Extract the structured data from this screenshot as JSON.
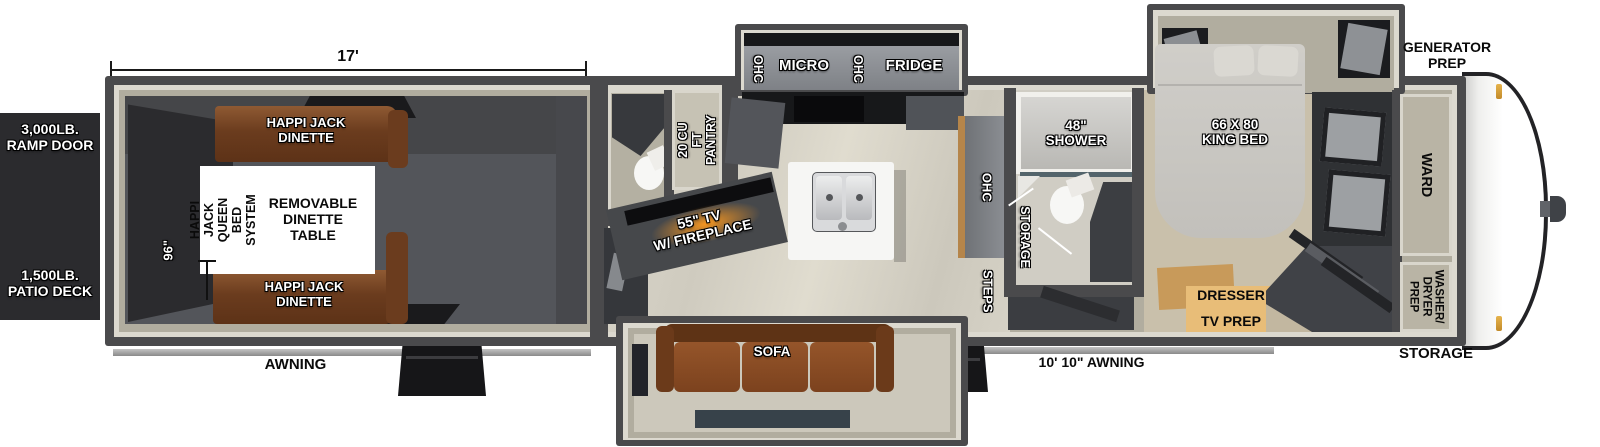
{
  "colors": {
    "wall": "#4a4a4c",
    "wall_lining": "#dcd9cf",
    "interior_tan": "#b1ad9f",
    "garage_floor": "#53555a",
    "side_panel": "#2b2b2e",
    "dinette_brown": "#7b4726",
    "sofa_brown": "#83491f",
    "fireplace_glow": "#ff9a1e",
    "dresser_tan": "#e8bd78"
  },
  "exterior": {
    "ramp_door": "3,000LB.\nRAMP DOOR",
    "patio_deck": "1,500LB.\nPATIO DECK",
    "garage_length": "17'",
    "garage_width": "96\"",
    "awning_rear": "AWNING",
    "awning_main": "10' 10\" AWNING",
    "generator_prep": "GENERATOR\nPREP",
    "storage": "STORAGE"
  },
  "garage": {
    "dinette_front": "HAPPI JACK\nDINETTE",
    "dinette_rear": "HAPPI JACK\nDINETTE",
    "queen_bed_system": "HAPPI JACK\nQUEEN BED\nSYSTEM",
    "removable_table": "REMOVABLE\nDINETTE\nTABLE"
  },
  "living": {
    "tv_fireplace": "55\" TV\nW/ FIREPLACE",
    "pantry": "20 CU FT\nPANTRY",
    "sofa": "SOFA",
    "steps": "STEPS",
    "counter_ohc": "OHC"
  },
  "kitchen": {
    "ohc_left": "OHC",
    "micro": "MICRO",
    "ohc_right": "OHC",
    "fridge": "FRIDGE"
  },
  "bathroom": {
    "shower": "48\"\nSHOWER",
    "storage": "STORAGE"
  },
  "bedroom": {
    "king_bed": "66 X 80\nKING BED",
    "dresser": "DRESSER",
    "tv_prep": "TV PREP",
    "wardrobe": "WARD",
    "washer_dryer_prep": "WASHER/\nDRYER\nPREP"
  }
}
